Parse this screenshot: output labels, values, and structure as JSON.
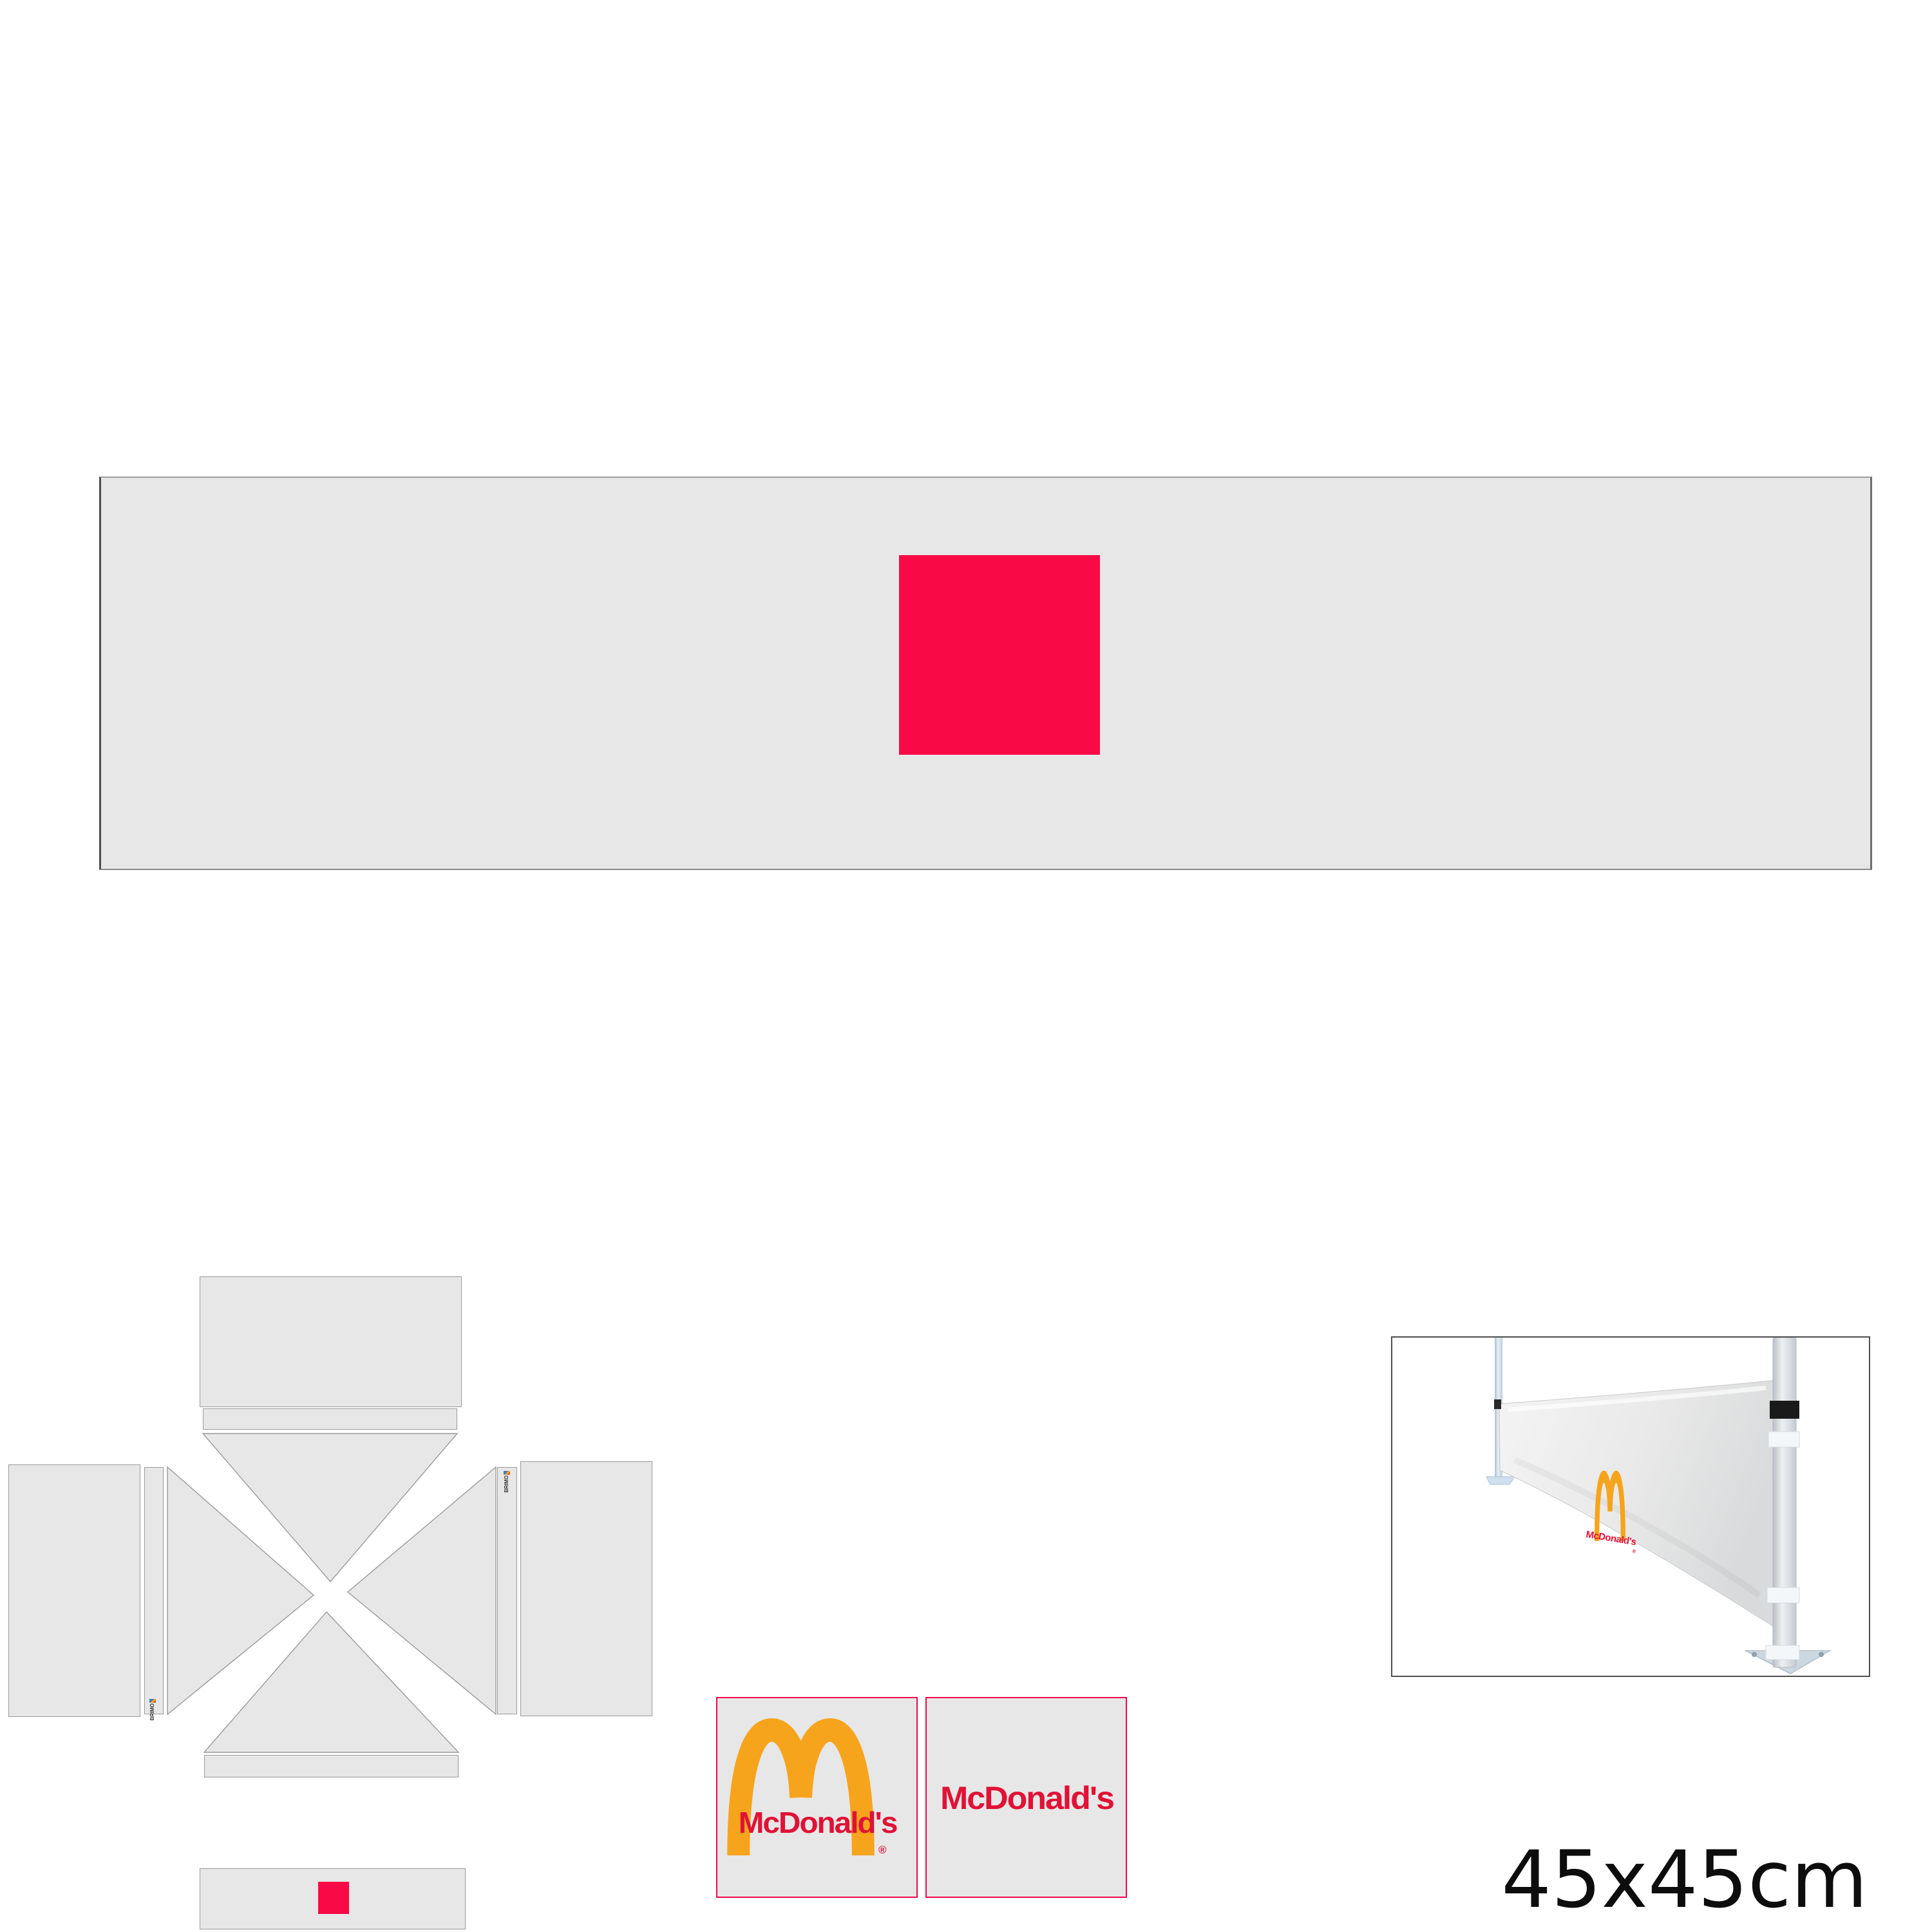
{
  "sheet": {
    "size_label": "45x45cm"
  },
  "logo": {
    "wordmark": "McDonald's",
    "registered_mark": "®"
  },
  "zipper_tag": {
    "brand": "BRIMO"
  },
  "colors": {
    "panel_fill": "#e7e7e7",
    "panel_border": "#9a9a9a",
    "print_area_red": "#f90a46",
    "swatch_border_red": "#f2074a",
    "arches_gold": "#f7a41d",
    "wordmark_red": "#e01236",
    "photo_frame": "#4f4f4f",
    "label_text": "#0d0d0d"
  },
  "icons": {
    "arches": "mcdonalds-golden-arches",
    "zipper_tag": "brimo-zipper-tag",
    "print_area": "logo-print-placement-square"
  }
}
